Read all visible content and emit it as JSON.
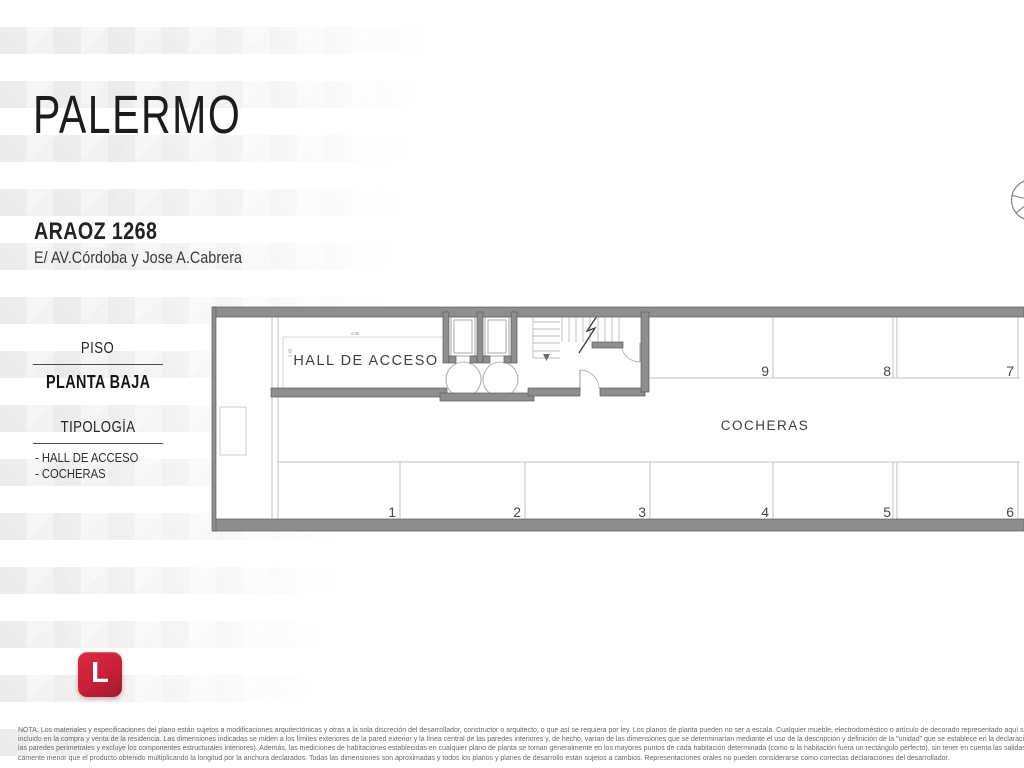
{
  "header": {
    "city": "PALERMO",
    "address": "ARAOZ 1268",
    "between": "E/ AV.Córdoba y Jose A.Cabrera"
  },
  "sidebar": {
    "floor_label": "PISO",
    "floor_value": "PLANTA BAJA",
    "typology_label": "TIPOLOGÍA",
    "typology_items": [
      "- HALL DE ACCESO",
      "- COCHERAS"
    ]
  },
  "plan": {
    "hall_label": "HALL DE ACCESO",
    "garage_label": "COCHERAS",
    "dim_width": "4.95",
    "dim_height": "2.45",
    "spaces": [
      "1",
      "2",
      "3",
      "4",
      "5",
      "6",
      "7",
      "8",
      "9"
    ]
  },
  "logo": {
    "letter": "L",
    "color": "#c72038"
  },
  "note_lines": [
    "NOTA: Los materiales y especificaciones del plano están sujetos a modificaciones arquitectónicas y otras a la sola discreción del desarrollador, constructor o arquitecto, o que así se requiera por ley. Los planos de planta pueden no ser a escala. Cualquier mueble, electrodoméstico o artículo de decorado representado aquí se muestra únicamente con fines artísticos e ilustrativos",
    "incluido en la compra y venta de la residencia. Las dimensiones indicadas se miden a los límites exteriores de la pared exterior y la línea central de las paredes interiores y, de hecho, varían de las dimensiones que se determinarían mediante el uso de la descripción y definición de la \"unidad\" que se establece en la declaración (que generalmente sólo incluye el espacio aéreo in",
    "las paredes perimetrales y excluye los componentes estructurales interiores). Además, las mediciones de habitaciones establecidas en cualquier plano de planta se toman generalmente en los mayores puntos de cada habitación determinada (como si la habitación fuera un rectángulo perfecto), sin tener en cuenta las salidas del corte. En consecuencia, el área de la habitación",
    "camente menor que el producto obtenido multiplicando la longitud por la anchura declarados. Todas las dimensiones son aproximadas y todos los planos y planes de desarrollo están sujetos a cambios. Representaciones orales no pueden considerarse como correctas declaraciones del desarrollador."
  ]
}
